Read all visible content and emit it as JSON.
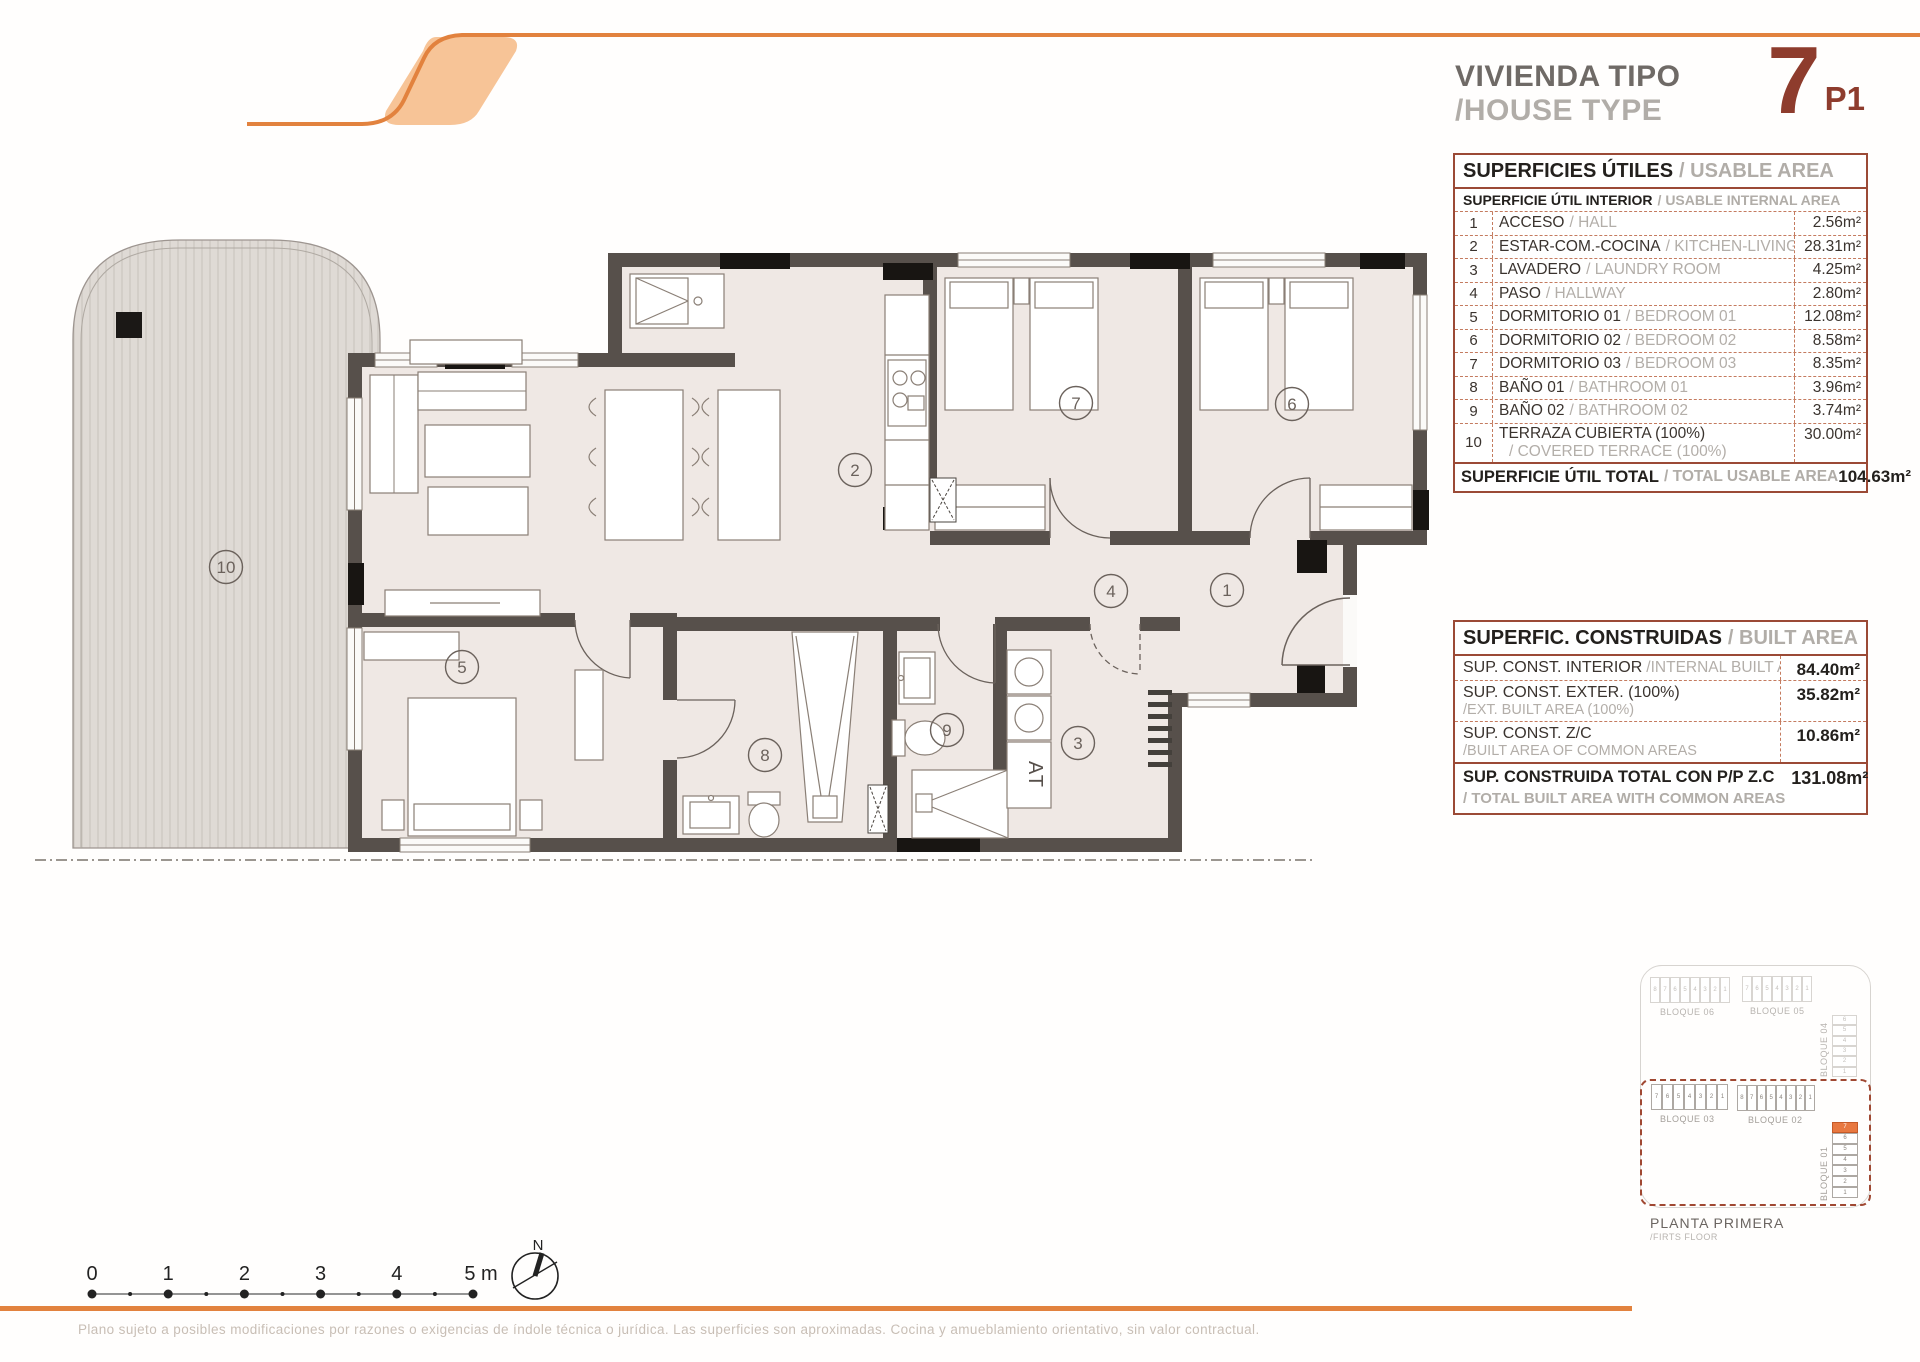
{
  "header": {
    "title_es": "VIVIENDA TIPO",
    "title_en": "/HOUSE TYPE",
    "type_number": "7",
    "type_floor": "P1"
  },
  "usable_table": {
    "title_es": "SUPERFICIES ÚTILES",
    "title_en": "/ USABLE AREA",
    "subtitle_es": "SUPERFICIE ÚTIL INTERIOR",
    "subtitle_en": "/ USABLE INTERNAL AREA",
    "rows": [
      {
        "num": "1",
        "es": "ACCESO",
        "en": "/ HALL",
        "value": "2.56m²"
      },
      {
        "num": "2",
        "es": "ESTAR-COM.-COCINA",
        "en": "/ KITCHEN-LIVING",
        "value": "28.31m²"
      },
      {
        "num": "3",
        "es": "LAVADERO",
        "en": "/ LAUNDRY ROOM",
        "value": "4.25m²"
      },
      {
        "num": "4",
        "es": "PASO",
        "en": "/ HALLWAY",
        "value": "2.80m²"
      },
      {
        "num": "5",
        "es": "DORMITORIO 01",
        "en": "/ BEDROOM 01",
        "value": "12.08m²"
      },
      {
        "num": "6",
        "es": "DORMITORIO 02",
        "en": "/ BEDROOM 02",
        "value": "8.58m²"
      },
      {
        "num": "7",
        "es": "DORMITORIO 03",
        "en": "/ BEDROOM 03",
        "value": "8.35m²"
      },
      {
        "num": "8",
        "es": "BAÑO 01",
        "en": "/ BATHROOM 01",
        "value": "3.96m²"
      },
      {
        "num": "9",
        "es": "BAÑO 02",
        "en": "/ BATHROOM 02",
        "value": "3.74m²"
      },
      {
        "num": "10",
        "es": "TERRAZA CUBIERTA (100%)",
        "en": "/ COVERED TERRACE (100%)",
        "value": "30.00m²",
        "twoline": true
      }
    ],
    "total_es": "SUPERFICIE ÚTIL TOTAL",
    "total_en": "/ TOTAL USABLE AREA",
    "total_value": "104.63m²"
  },
  "built_table": {
    "title_es": "SUPERFIC. CONSTRUIDAS",
    "title_en": "/ BUILT AREA",
    "rows": [
      {
        "es": "SUP. CONST. INTERIOR",
        "en": "/INTERNAL BUILT AREA",
        "value": "84.40m²",
        "inline": true
      },
      {
        "es": "SUP. CONST. EXTER. (100%)",
        "en": "/EXT. BUILT AREA (100%)",
        "value": "35.82m²"
      },
      {
        "es": "SUP. CONST. Z/C",
        "en": "/BUILT AREA OF COMMON AREAS",
        "value": "10.86m²"
      }
    ],
    "total_es": "SUP. CONSTRUIDA TOTAL CON P/P Z.C",
    "total_en": "/ TOTAL BUILT AREA WITH COMMON AREAS",
    "total_value": "131.08m²"
  },
  "plan": {
    "rooms": [
      "1",
      "2",
      "3",
      "4",
      "5",
      "6",
      "7",
      "8",
      "9",
      "10"
    ],
    "at_label": "AT"
  },
  "scale_bar": {
    "ticks": [
      "0",
      "1",
      "2",
      "3",
      "4",
      "5 m"
    ]
  },
  "north_label": "N",
  "site_plan": {
    "blocks": [
      {
        "id": "b06",
        "name": "BLOQUE 06",
        "cells": [
          "8",
          "7",
          "6",
          "5",
          "4",
          "3",
          "2",
          "1"
        ],
        "dimmed": true
      },
      {
        "id": "b05",
        "name": "BLOQUE 05",
        "cells": [
          "7",
          "6",
          "5",
          "4",
          "3",
          "2",
          "1"
        ],
        "dimmed": true
      },
      {
        "id": "b04",
        "name": "BLOQUE 04",
        "cells": [
          "6",
          "5",
          "4",
          "3",
          "2",
          "1"
        ],
        "dimmed": true
      },
      {
        "id": "b03",
        "name": "BLOQUE 03",
        "cells": [
          "7",
          "6",
          "5",
          "4",
          "3",
          "2",
          "1"
        ],
        "dimmed": false
      },
      {
        "id": "b02",
        "name": "BLOQUE 02",
        "cells": [
          "8",
          "7",
          "6",
          "5",
          "4",
          "3",
          "2",
          "1"
        ],
        "dimmed": false
      },
      {
        "id": "b01",
        "name": "BLOQUE 01",
        "cells": [
          "7",
          "6",
          "5",
          "4",
          "3",
          "2",
          "1"
        ],
        "dimmed": false,
        "highlight": "7"
      }
    ],
    "caption_es": "PLANTA PRIMERA",
    "caption_en": "/FIRTS FLOOR"
  },
  "footer": {
    "disclaimer": "Plano sujeto a posibles modificaciones por razones o exigencias de índole técnica o jurídica. Las superficies son aproximadas. Cocina y amueblamiento orientativo, sin valor contractual."
  },
  "colors": {
    "accent_orange": "#E2823E",
    "logo_fill": "#F7C497",
    "maroon": "#8E3C2D",
    "table_border": "#9B4A36",
    "wall": "#57504B",
    "floor": "#EFE8E4",
    "terrace": "#DFDAD5",
    "highlight_cell": "#E87840"
  }
}
